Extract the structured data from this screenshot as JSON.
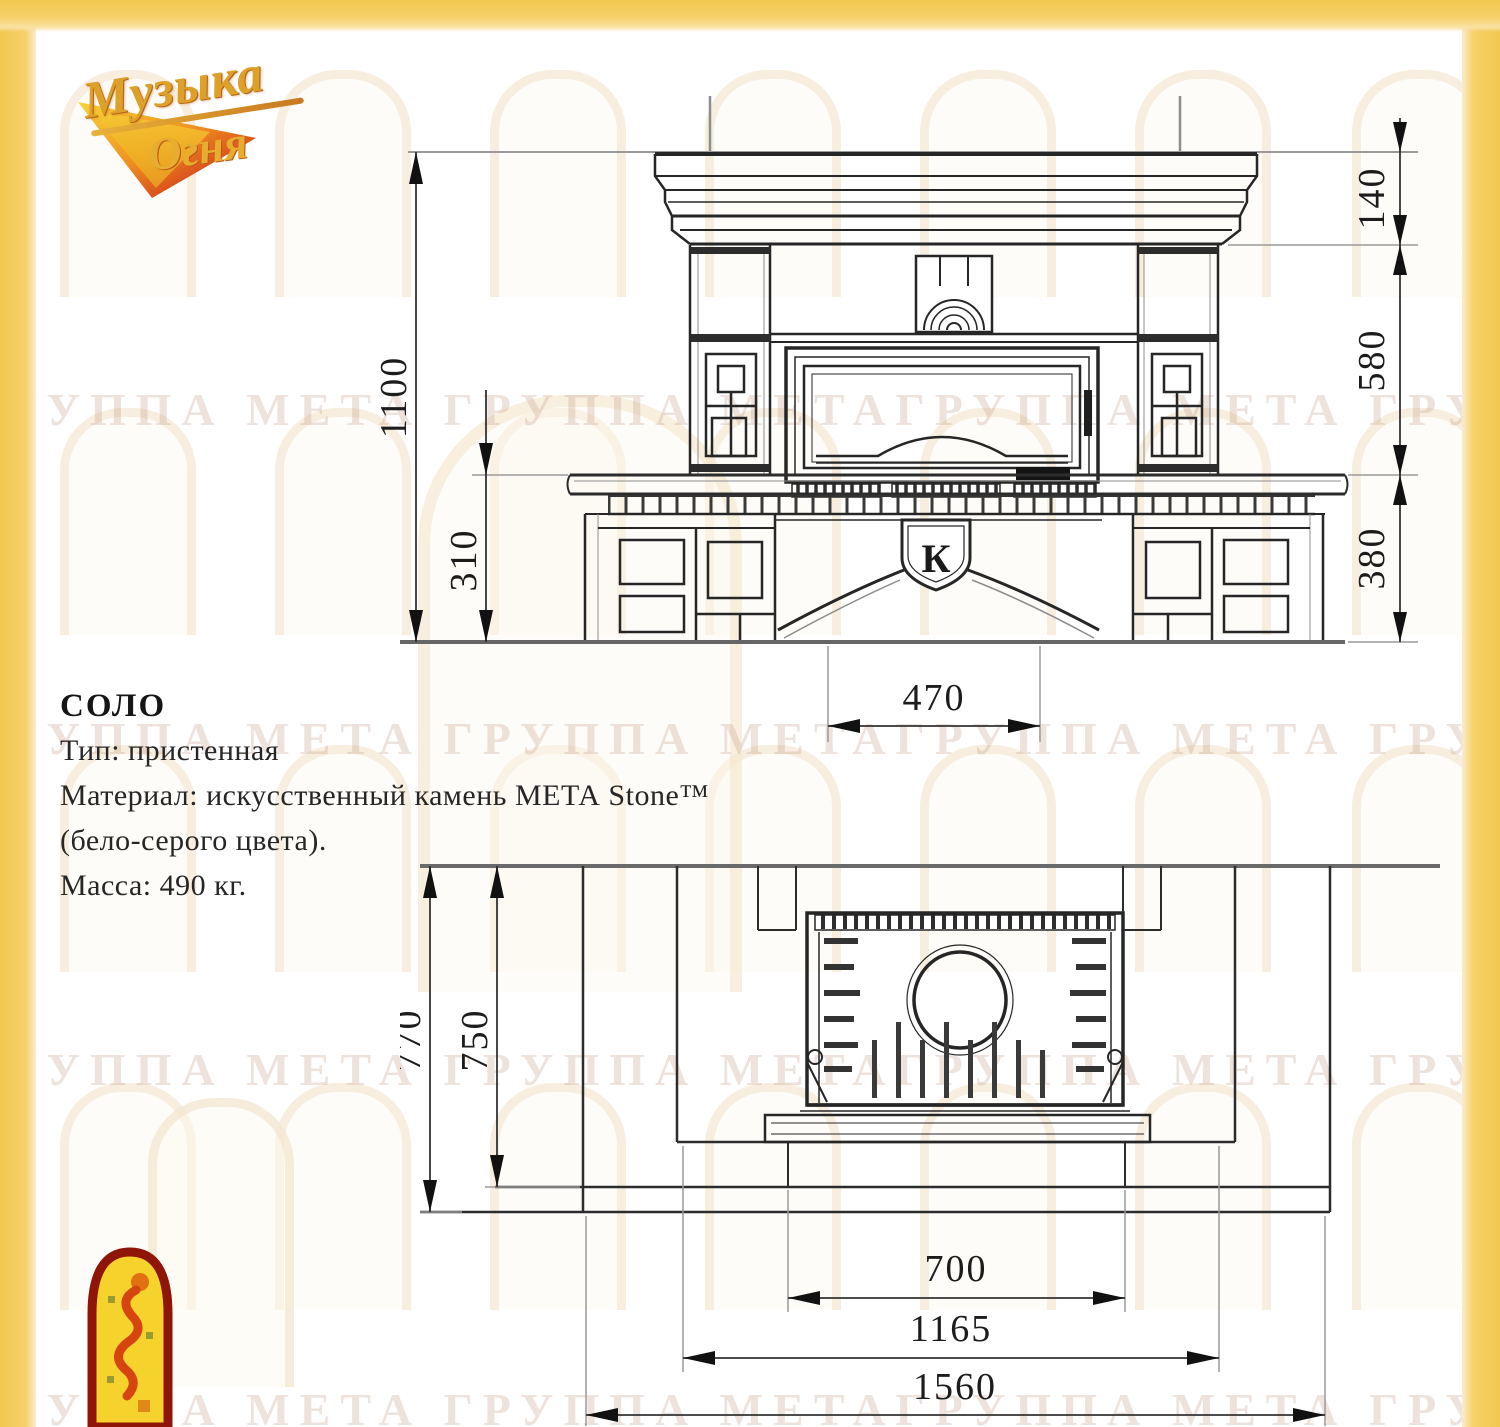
{
  "logo": {
    "word1": "Музыка",
    "word2": "Огня"
  },
  "watermark": {
    "text": "ГРУППА МЕТА ГРУППА МЕТАГРУППА МЕТА ГРУППА МЕТАГРУППА МЕТА"
  },
  "specs": {
    "title": "СОЛО",
    "type_line": "Тип: пристенная",
    "material_line1": "Материал: искусственный камень МЕТА Stone™",
    "material_line2": "(бело-серого цвета).",
    "mass_line": "Масса: 490 кг."
  },
  "front_view": {
    "emblem_letter": "К",
    "dims": {
      "total_height": "1100",
      "hearth_height": "310",
      "mantel_height": "140",
      "opening_height": "580",
      "base_height": "380",
      "opening_width": "470"
    }
  },
  "plan_view": {
    "dims": {
      "total_depth": "770",
      "inner_depth": "750",
      "hearth_width": "700",
      "middle_width": "1165",
      "total_width": "1560"
    }
  },
  "colors": {
    "frame_yellow": "#f6d06a",
    "line_dark": "#262626",
    "line_gray": "#9a9a9a",
    "logo_gold": "#dca128",
    "emblem_red": "#8f1509",
    "emblem_yellow": "#f6d22c"
  }
}
